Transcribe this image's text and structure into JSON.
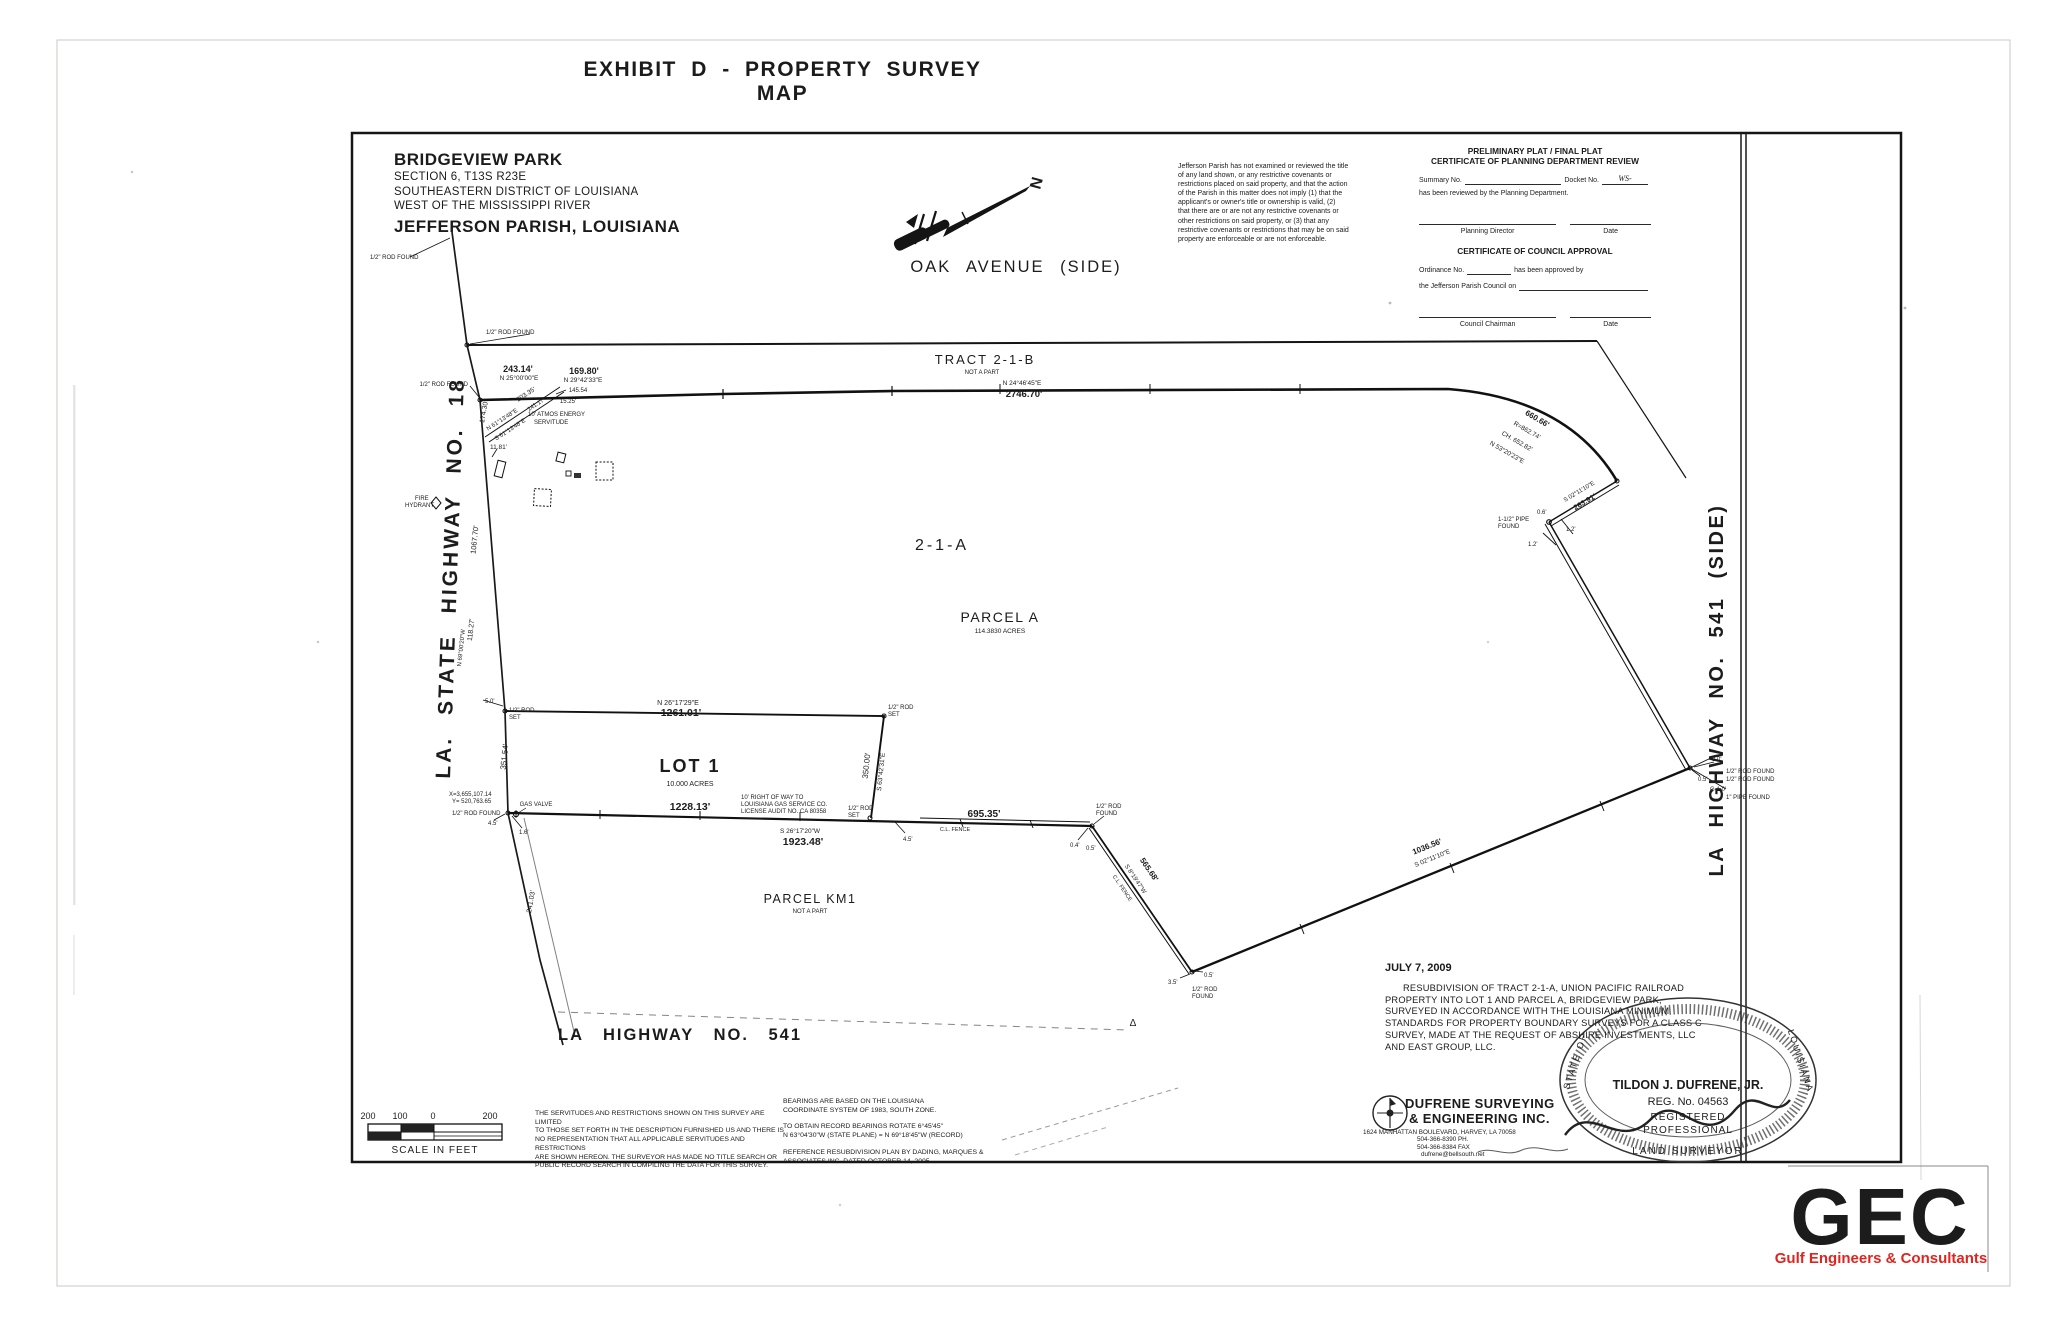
{
  "page": {
    "exhibit_title": "EXHIBIT D - PROPERTY  SURVEY  MAP",
    "paper_color": "#ffffff",
    "ink_color": "#1c1c1c"
  },
  "title_block": {
    "line1": "BRIDGEVIEW PARK",
    "line2": "SECTION 6, T13S  R23E",
    "line3": "SOUTHEASTERN DISTRICT OF LOUISIANA",
    "line4": "WEST OF THE MISSISSIPPI RIVER",
    "line5": "JEFFERSON PARISH, LOUISIANA"
  },
  "north_arrow": {
    "n": "N",
    "street": "OAK   AVENUE   (SIDE)"
  },
  "disclaimer": {
    "lines": [
      "Jefferson Parish has not examined or reviewed the title",
      "of any land shown, or any restrictive covenants or",
      "restrictions placed on said property, and that the action",
      "of the Parish in this matter does not imply (1) that the",
      "applicant's or owner's title or ownership is valid, (2)",
      "that there are or are not any restrictive covenants or",
      "other restrictions on said property, or (3) that any",
      "restrictive covenants or restrictions that may be on said",
      "property are enforceable or are not enforceable."
    ]
  },
  "certificate": {
    "t1": "PRELIMINARY PLAT / FINAL PLAT",
    "t2": "CERTIFICATE OF PLANNING DEPARTMENT REVIEW",
    "summary": "Summary No.",
    "docket": "Docket No.",
    "ws": "WS-",
    "reviewed": "has been reviewed by the Planning Department.",
    "dir": "Planning Director",
    "date": "Date",
    "t3": "CERTIFICATE OF COUNCIL APPROVAL",
    "ord1a": "Ordinance No.",
    "ord1b": "has been approved by",
    "ord2": "the Jefferson Parish Council on",
    "chair": "Council Chairman",
    "date2": "Date"
  },
  "plat": {
    "tract21b": "TRACT 2-1-B",
    "tract21b_note": "NOT A PART",
    "north_bearing": "N 24°46'45\"E",
    "north_dist": "2746.70'",
    "area21a": "2-1-A",
    "parcelA": "PARCEL A",
    "parcelA_acres": "114.3830 ACRES",
    "lot1": "LOT 1",
    "lot1_acres": "10.000 ACRES",
    "parcelKM1": "PARCEL KM1",
    "parcelKM1_note": "NOT A PART",
    "seg243": "243.14'",
    "seg243_b": "N 25°00'00\"E",
    "seg169": "169.80'",
    "seg169_b": "N 29°42'33\"E",
    "lot1_n": "1261.01'",
    "lot1_n_b": "N 26°17'29\"E",
    "lot1_s": "1228.13'",
    "south_b": "S 26°17'20\"W",
    "south_d": "1923.48'",
    "seg695": "695.35'",
    "clfence": "C.L. FENCE",
    "seg565": "565.68'",
    "seg565_b": "S 8°19'47\"W",
    "diag": "1036.56'",
    "diag_b": "S 02°11'10\"E",
    "seg263": "263.91'",
    "seg263_b": "S 02°11'10\"E",
    "curve_len": "660.66'",
    "curve_r": "R=862.74'",
    "curve_ch": "CH. 652.82'",
    "curve_b": "N 53°20'23\"E",
    "pipe15a": "1-1/2\" PIPE",
    "pipe15b": "FOUND",
    "rod_found": "1/2\" ROD FOUND",
    "rod2a": "1/2\" ROD",
    "set_w": "SET",
    "found_w": "FOUND",
    "pipe1": "1\" PIPE FOUND",
    "g10": "G-1.0'",
    "off05": "0.5'",
    "off80": "8.0'",
    "off12": "1.2'",
    "off06": "0.6'",
    "off04": "0.4'",
    "off35": "3.5'",
    "off45": "4.5'",
    "off50": "5.0'",
    "off16": "1.6'",
    "e350": "350.00'",
    "e350_b": "S 63°42'31\"E",
    "w17430": "174.30'",
    "w106770": "1067.70'",
    "w11827": "118.27'",
    "w11827_b": "N 69°00'20\"W",
    "w35154": "351.54'",
    "w24103": "241.03'",
    "coordX": "X=3,655,107.14",
    "coordY": "Y= 520,763.65",
    "gas_valve": "GAS VALVE",
    "fire1": "FIRE",
    "fire2": "HYDRANT",
    "atmos1": "10' ATMOS ENERGY",
    "atmos2": "SERVITUDE",
    "s20335": "203.35'",
    "s14117": "141.17'",
    "s1525": "15.25'",
    "s14554": "145.54",
    "s1181": "11.81'",
    "serv_b1": "N 61°13'48\"E",
    "serv_b2": "S 61°13'48\"E",
    "row_note1": "10' RIGHT OF WAY TO",
    "row_note2": "LOUISIANA GAS SERVICE CO.",
    "row_note3": "LICENSE AUDIT NO. CA 80358",
    "hwy18": "LA.   STATE   HIGHWAY   NO.   18",
    "hwy541side": "LA  HIGHWAY  NO.  541  (SIDE)",
    "hwy541": "LA   HIGHWAY   NO.   541",
    "delta": "Δ"
  },
  "scalebar": {
    "a": "200",
    "b": "100",
    "c": "0",
    "d": "200",
    "caption": "SCALE IN FEET"
  },
  "notes": {
    "servitude": [
      "THE SERVITUDES AND RESTRICTIONS SHOWN ON THIS SURVEY ARE LIMITED",
      "TO THOSE SET FORTH IN THE DESCRIPTION FURNISHED US AND THERE IS",
      "NO REPRESENTATION THAT ALL APPLICABLE SERVITUDES AND RESTRICTIONS",
      "ARE SHOWN HEREON.  THE SURVEYOR HAS MADE NO TITLE SEARCH OR",
      "PUBLIC RECORD SEARCH IN COMPILING THE DATA FOR THIS SURVEY."
    ],
    "bearings1a": "BEARINGS ARE BASED ON THE LOUISIANA",
    "bearings1b": "COORDINATE SYSTEM OF 1983, SOUTH ZONE.",
    "bearings2a": "TO OBTAIN RECORD BEARINGS ROTATE 6°45'45\"",
    "bearings2b": "N 63°04'30\"W (STATE PLANE) = N 69°18'45\"W (RECORD)",
    "reference1": "REFERENCE RESUBDIVISION PLAN BY DADING, MARQUES &",
    "reference2": "ASSOCIATES INC. DATED OCTOBER 14, 2005"
  },
  "certification": {
    "date": "JULY 7, 2009",
    "lines": [
      "RESUBDIVISION OF TRACT 2-1-A, UNION PACIFIC RAILROAD",
      "PROPERTY INTO LOT 1 AND PARCEL A, BRIDGEVIEW PARK,",
      "SURVEYED IN ACCORDANCE WITH THE LOUISIANA MINIMUM",
      "STANDARDS FOR PROPERTY BOUNDARY SURVEYS FOR A CLASS C",
      "SURVEY, MADE AT THE REQUEST OF ABSHIRE INVESTMENTS, LLC",
      "AND EAST GROUP, LLC."
    ]
  },
  "firm": {
    "name1": "DUFRENE SURVEYING",
    "name2": "& ENGINEERING INC.",
    "addr": "1624 MANHATTAN BOULEVARD, HARVEY, LA  70058",
    "ph": "504-366-8390 PH.",
    "fax": "504-366-8384 FAX",
    "email": "dufrene@bellsouth.net"
  },
  "seal": {
    "name": "TILDON J. DUFRENE, JR.",
    "reg": "REG. No. 04563",
    "r1": "REGISTERED",
    "r2": "PROFESSIONAL",
    "r3": "LAND SURVEYOR",
    "arc1": "STATE OF",
    "arc2": "LOUISIANA"
  },
  "gec": {
    "letters": "GEC",
    "tagline": "Gulf Engineers & Consultants",
    "blue": "#1d2f86",
    "orange": "#e8481c",
    "red": "#e02520"
  }
}
